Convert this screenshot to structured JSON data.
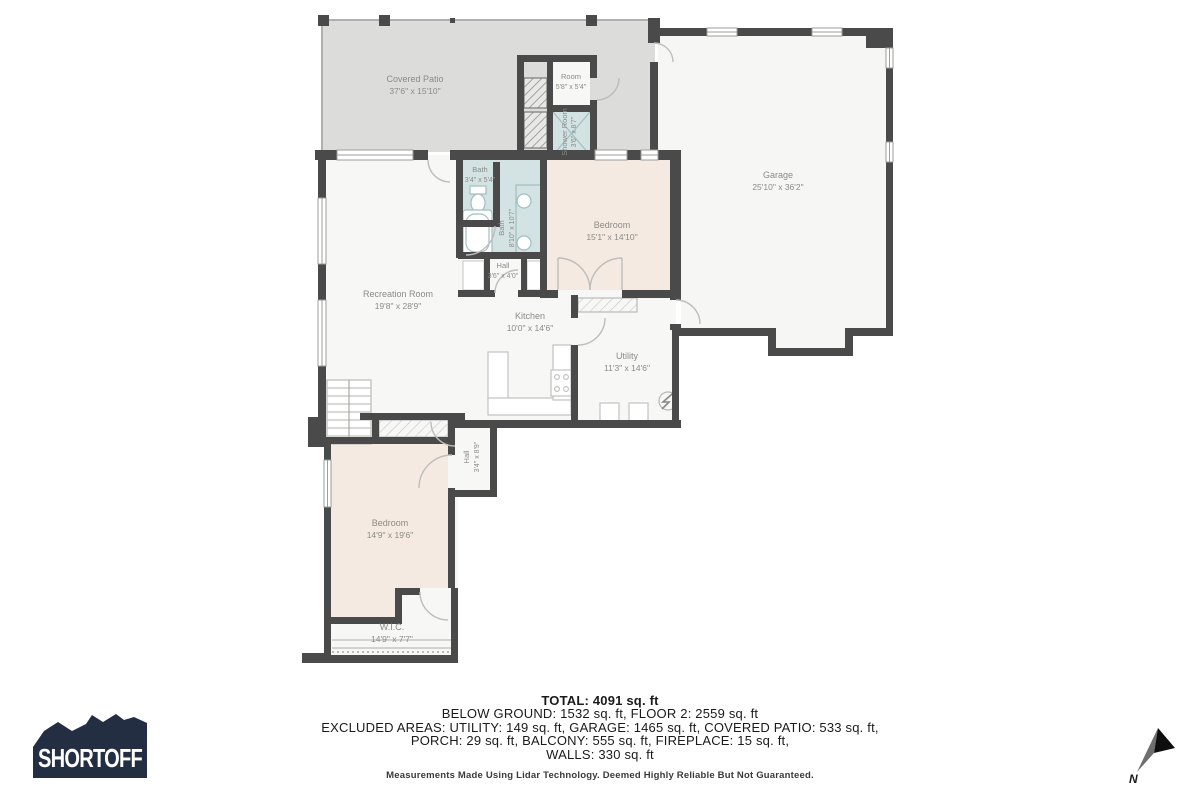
{
  "rooms": {
    "covered_patio": {
      "name": "Covered Patio",
      "dims": "37'6\" x 15'10\""
    },
    "room": {
      "name": "Room",
      "dims": "5'8\" x 5'4\""
    },
    "shower_room": {
      "name": "Shower Room",
      "dims": "3'6\" x 8'7\""
    },
    "garage": {
      "name": "Garage",
      "dims": "25'10\" x 36'2\""
    },
    "bath_small": {
      "name": "Bath",
      "dims": "3'4\" x 5'4\""
    },
    "bath_large": {
      "name": "Bath",
      "dims": "8'10\" x 10'7\""
    },
    "hall_small": {
      "name": "Hall",
      "dims": "3'6\" x 4'0\""
    },
    "bedroom_upper": {
      "name": "Bedroom",
      "dims": "15'1\" x 14'10\""
    },
    "recreation_room": {
      "name": "Recreation Room",
      "dims": "19'8\" x 28'9\""
    },
    "kitchen": {
      "name": "Kitchen",
      "dims": "10'0\" x 14'6\""
    },
    "utility": {
      "name": "Utility",
      "dims": "11'3\" x 14'6\""
    },
    "hall_vertical": {
      "name": "Hall",
      "dims": "3'4\" x 8'9\""
    },
    "bedroom_lower": {
      "name": "Bedroom",
      "dims": "14'9\" x 19'6\""
    },
    "wic": {
      "name": "W.I.C.",
      "dims": "14'9\" x 7'7\""
    }
  },
  "summary": {
    "total": "TOTAL: 4091 sq. ft",
    "line2": "BELOW GROUND: 1532 sq. ft, FLOOR 2: 2559 sq. ft",
    "line3": "EXCLUDED AREAS: UTILITY: 149 sq. ft, GARAGE: 1465 sq. ft, COVERED PATIO: 533 sq. ft,",
    "line4": "PORCH: 29 sq. ft, BALCONY: 555 sq. ft, FIREPLACE: 15 sq. ft,",
    "line5": "WALLS: 330 sq. ft",
    "disclaimer": "Measurements Made Using Lidar Technology. Deemed Highly Reliable But Not Guaranteed."
  },
  "logo": {
    "text": "SHORTOFF"
  },
  "compass": {
    "label": "N"
  },
  "colors": {
    "wall": "#4a4a4a",
    "patio_fill": "#dcdcdb",
    "room_fill": "#f7f7f5",
    "bedroom_fill": "#f5eae2",
    "bath_fill": "#d3e2e3",
    "label_text": "#8b8b86",
    "logo_background": "#232e42",
    "summary_text": "#1a1a1a"
  }
}
